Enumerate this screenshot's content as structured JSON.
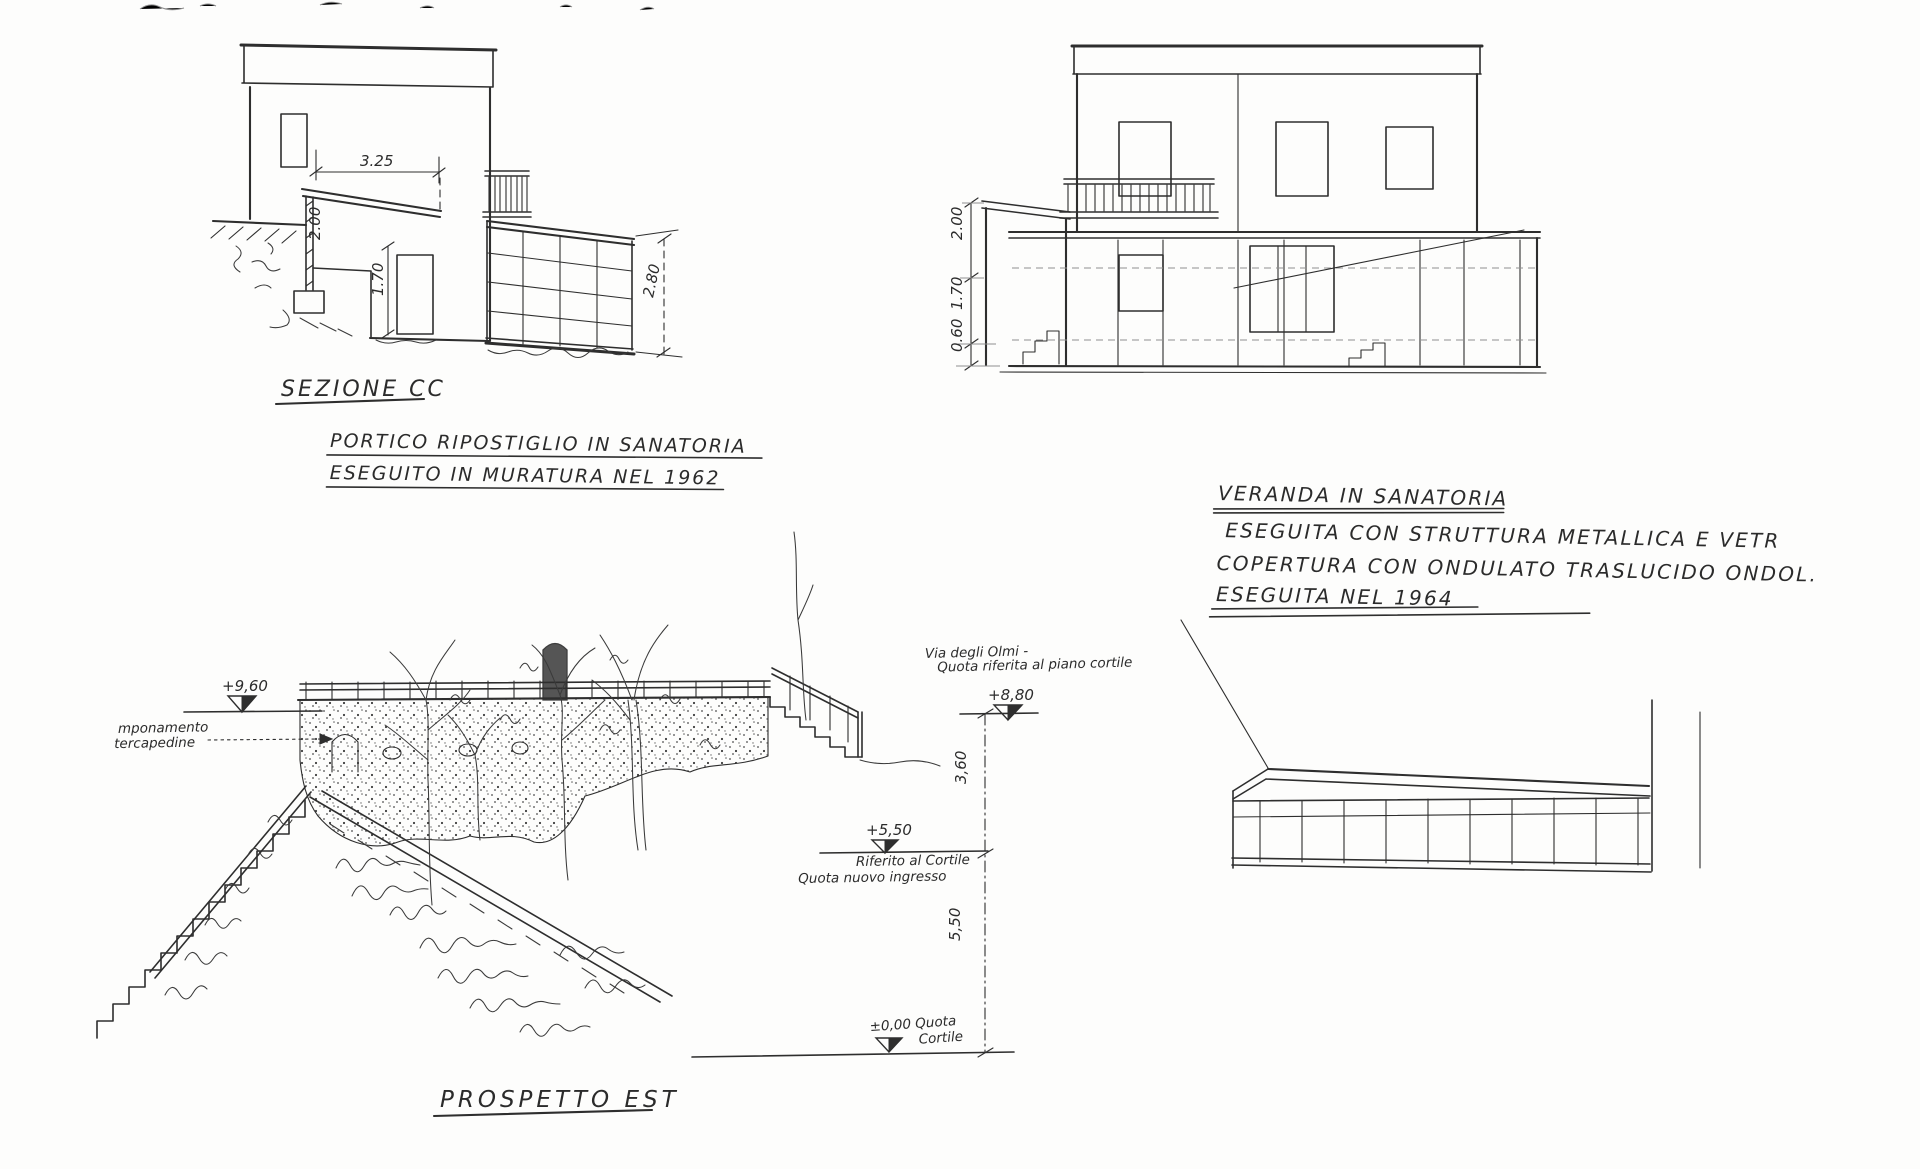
{
  "section_cc": {
    "title": "SEZIONE CC",
    "caption1": "PORTICO RIPOSTIGLIO IN SANATORIA",
    "caption2": "ESEGUITO IN MURATURA NEL 1962",
    "dim_width": "3.25",
    "dim_post_height": "2.00",
    "dim_door_height": "1.70",
    "dim_glass_height": "2.80"
  },
  "front_elevation": {
    "dim_upper": "2.00",
    "dim_middle": "1.70",
    "dim_lower": "0.60"
  },
  "veranda_note": {
    "line1": "VERANDA IN SANATORIA",
    "line2": "ESEGUITA CON STRUTTURA METALLICA E VETR",
    "line3": "COPERTURA CON ONDULATO TRASLUCIDO ONDOL.",
    "line4": "ESEGUITA NEL 1964"
  },
  "prospetto_est": {
    "title": "PROSPETTO EST",
    "level_top": "+9,60",
    "level_street": "+8,80",
    "level_entrance": "+5,50",
    "level_zero_line1": "±0,00 Quota",
    "level_zero_line2": "Cortile",
    "dim_upper": "3,60",
    "dim_lower": "5,50",
    "label_wall_line1": "mponamento",
    "label_wall_line2": "tercapedine",
    "label_street_line1": "Via degli Olmi -",
    "label_street_line2": "Quota riferita al piano cortile",
    "label_entrance_line1": "Riferito al Cortile",
    "label_entrance_line2": "Quota nuovo ingresso"
  }
}
